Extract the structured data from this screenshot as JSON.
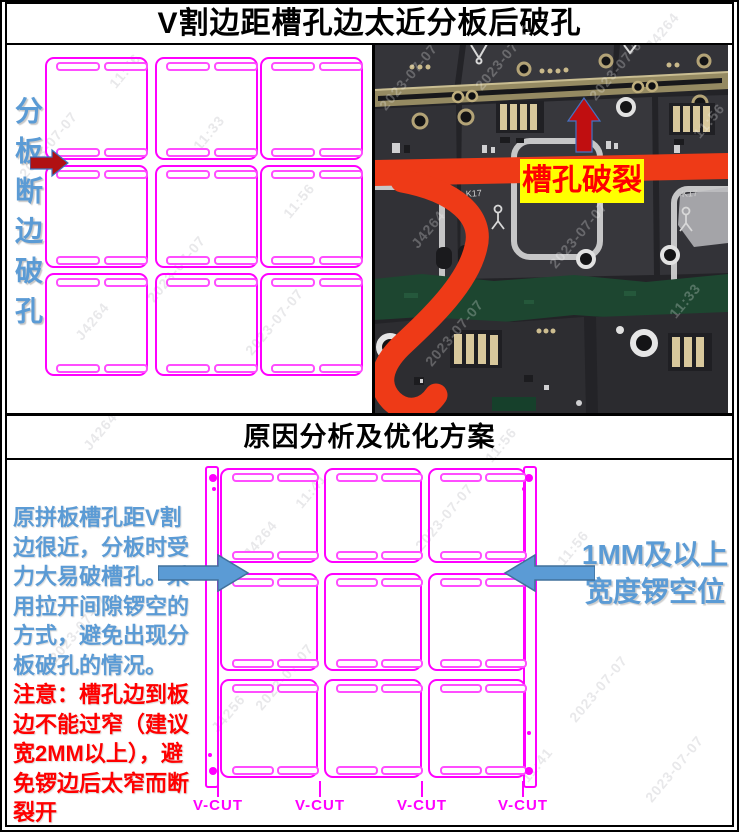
{
  "page": {
    "title_top": "V割边距槽孔边太近分板后破孔",
    "title_middle": "原因分析及优化方案"
  },
  "top_section": {
    "vertical_label": "分板断边破孔",
    "panel_grid": {
      "rows": 3,
      "cols": 3
    },
    "photo": {
      "crack_label": "槽孔破裂",
      "chip_ref": "K17"
    }
  },
  "bottom_section": {
    "panel_grid": {
      "rows": 3,
      "cols": 3
    },
    "note_blue": "原拼板槽孔距V割边很近，分板时受力大易破槽孔。采用拉开间隙锣空的方式，避免出现分板破孔的情况。",
    "note_red": "注意：槽孔边到板边不能过窄（建议宽2MM以上），避免锣边后太窄而断裂开",
    "right_label_line1": "1MM及以上",
    "right_label_line2": "宽度锣空位",
    "vcut_labels": [
      "V-CUT",
      "V-CUT",
      "V-CUT",
      "V-CUT"
    ]
  },
  "watermarks": [
    {
      "text": "11:56",
      "x": 112,
      "y": 78,
      "kind": "gray"
    },
    {
      "text": "2023-07-07",
      "x": 22,
      "y": 168,
      "kind": "gray"
    },
    {
      "text": "11:33",
      "x": 196,
      "y": 140,
      "kind": "gray"
    },
    {
      "text": "11:56",
      "x": 286,
      "y": 208,
      "kind": "gray"
    },
    {
      "text": "2023-07-07",
      "x": 150,
      "y": 292,
      "kind": "gray"
    },
    {
      "text": "J4264",
      "x": 78,
      "y": 330,
      "kind": "gray"
    },
    {
      "text": "2023-07-07",
      "x": 248,
      "y": 345,
      "kind": "gray"
    },
    {
      "text": "J4264",
      "x": 648,
      "y": 40,
      "kind": "gray"
    },
    {
      "text": "11:56",
      "x": 488,
      "y": 452,
      "kind": "gray"
    },
    {
      "text": "J4264",
      "x": 86,
      "y": 440,
      "kind": "gray"
    },
    {
      "text": "J4264",
      "x": 246,
      "y": 548,
      "kind": "gray"
    },
    {
      "text": "11:41",
      "x": 298,
      "y": 498,
      "kind": "gray"
    },
    {
      "text": "2023-07-07",
      "x": 418,
      "y": 540,
      "kind": "gray"
    },
    {
      "text": "11:56",
      "x": 560,
      "y": 555,
      "kind": "gray"
    },
    {
      "text": "2023-07-07",
      "x": 52,
      "y": 652,
      "kind": "gray"
    },
    {
      "text": "J4256",
      "x": 214,
      "y": 722,
      "kind": "gray"
    },
    {
      "text": "2023-07-07",
      "x": 258,
      "y": 700,
      "kind": "gray"
    },
    {
      "text": "2023-07-07",
      "x": 572,
      "y": 712,
      "kind": "gray"
    },
    {
      "text": "2023-07-07",
      "x": 648,
      "y": 792,
      "kind": "gray"
    },
    {
      "text": "11:41",
      "x": 524,
      "y": 772,
      "kind": "gray"
    },
    {
      "text": "2023-07-07",
      "x": 382,
      "y": 100,
      "kind": "white"
    },
    {
      "text": "2023-07-07",
      "x": 478,
      "y": 80,
      "kind": "white"
    },
    {
      "text": "2023-07-07",
      "x": 592,
      "y": 90,
      "kind": "white"
    },
    {
      "text": "11:56",
      "x": 696,
      "y": 128,
      "kind": "white"
    },
    {
      "text": "J4264",
      "x": 414,
      "y": 238,
      "kind": "white"
    },
    {
      "text": "2023-07-07",
      "x": 552,
      "y": 258,
      "kind": "white"
    },
    {
      "text": "11:33",
      "x": 672,
      "y": 308,
      "kind": "white"
    },
    {
      "text": "2023-07-07",
      "x": 428,
      "y": 356,
      "kind": "white"
    }
  ],
  "colors": {
    "panel_outline": "#FF00FF",
    "slot_outline": "#FF4DFF",
    "note_blue": "#5B9BD5",
    "note_red": "#FF0000",
    "crack_label_bg": "#FFFF00",
    "crack_label_text": "#FF0000",
    "dark_red_arrow": "#B01113",
    "blue_arrow_fill": "#5B9BD5",
    "blue_arrow_stroke": "#41719C",
    "red_overlay": "#EE3A17"
  }
}
